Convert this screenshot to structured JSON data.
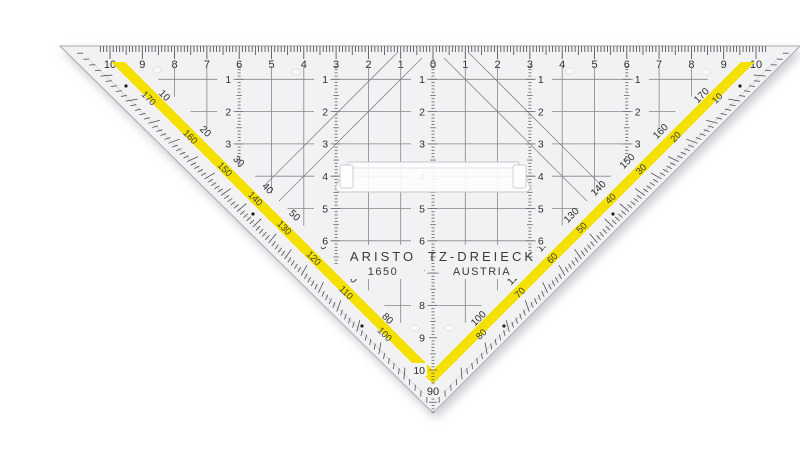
{
  "product": {
    "brand": "ARISTO",
    "model": "1650",
    "name": "TZ-DREIECK",
    "country": "AUSTRIA",
    "vertex_degree_label": "90"
  },
  "top_ruler": {
    "labels_left_to_right": [
      "10",
      "9",
      "8",
      "7",
      "6",
      "5",
      "4",
      "3",
      "2",
      "1",
      "0",
      "1",
      "2",
      "3",
      "4",
      "5",
      "6",
      "7",
      "8",
      "9",
      "10"
    ]
  },
  "protractor": {
    "left_edge": {
      "band_labels": [
        "10",
        "20",
        "30",
        "40",
        "50",
        "60",
        "70",
        "80"
      ],
      "outer_labels": [
        "170",
        "160",
        "150",
        "140",
        "130",
        "120",
        "110",
        "100"
      ]
    },
    "right_edge": {
      "band_labels": [
        "170",
        "160",
        "150",
        "140",
        "130",
        "120",
        "110",
        "100"
      ],
      "outer_labels": [
        "10",
        "20",
        "30",
        "40",
        "50",
        "60",
        "70",
        "80"
      ]
    }
  },
  "mm_columns": [
    {
      "position_cm": -6,
      "labels": [
        "1",
        "2",
        "3"
      ],
      "label_side": "left"
    },
    {
      "position_cm": -3,
      "labels": [
        "1",
        "2",
        "3",
        "4",
        "5",
        "6"
      ],
      "label_side": "left"
    },
    {
      "position_cm": 0,
      "labels": [
        "1",
        "2",
        "3",
        "4",
        "5",
        "6",
        "7",
        "8",
        "9",
        "10"
      ],
      "label_side": "left"
    },
    {
      "position_cm": 3,
      "labels": [
        "1",
        "2",
        "3",
        "4",
        "5",
        "6"
      ],
      "label_side": "right"
    },
    {
      "position_cm": 6,
      "labels": [
        "1",
        "2",
        "3"
      ],
      "label_side": "right"
    }
  ],
  "colors": {
    "plastic": "#f2f2f4",
    "plastic_edge": "#b7b7bc",
    "bevel": "#dadade",
    "grid_line": "#86868b",
    "tick": "#45454a",
    "scale_text": "#2e2e32",
    "degree_text": "#3a3a3e",
    "band_yellow": "#f4e102",
    "band_text": "#2b2b2e",
    "column_dash": "#6f6f74",
    "handle_stroke": "#c6c6cb",
    "dot": "#1e1e22"
  }
}
